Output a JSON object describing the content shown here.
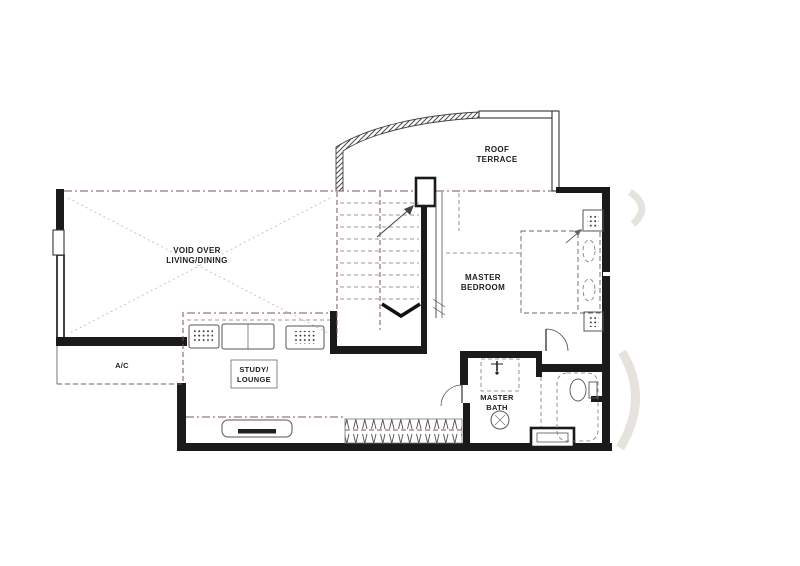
{
  "colors": {
    "wall": "#1a1a1a",
    "line": "#555555",
    "accent": "#7c584a",
    "faint": "#c6bdb2",
    "paper": "#ffffff"
  },
  "labels": {
    "roof_terrace": {
      "line1": "ROOF",
      "line2": "TERRACE"
    },
    "void": {
      "line1": "VOID OVER",
      "line2": "LIVING/DINING"
    },
    "master_bedroom": {
      "line1": "MASTER",
      "line2": "BEDROOM"
    },
    "ac": {
      "line1": "A/C"
    },
    "study_lounge": {
      "line1": "STUDY/",
      "line2": "LOUNGE"
    },
    "master_bath": {
      "line1": "MASTER",
      "line2": "BATH"
    }
  }
}
